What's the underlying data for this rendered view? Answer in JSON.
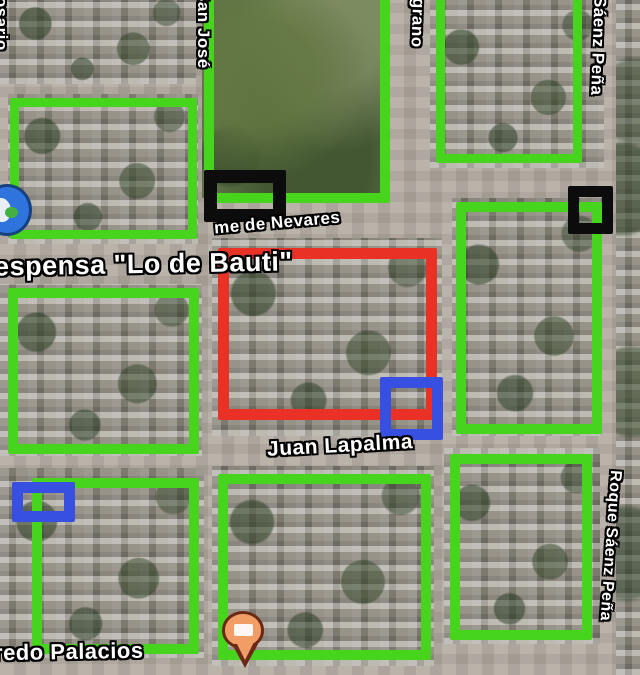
{
  "map_view": {
    "type": "satellite-map-screenshot",
    "width": 640,
    "height": 675
  },
  "colors": {
    "annotation_green": "#46d41c",
    "annotation_red": "#e93126",
    "annotation_blue": "#3850e2",
    "annotation_black": "#0c0c0c",
    "road": "#b2aaa0",
    "block": "#8f8b80",
    "field_green": "#5e7247",
    "label_text": "#ffffff",
    "label_halo": "#000000",
    "pin_fill": "#f09e66",
    "pin_border": "#6b2815",
    "pin_glyph": "#ffffff",
    "poi_icon_fill": "#2e74dc"
  },
  "street_labels": [
    {
      "name": "street-label-rosario",
      "text": "Rosario",
      "vertical": true,
      "x": -8,
      "y": -16,
      "size": 17,
      "rot": 0
    },
    {
      "name": "street-label-san-jose",
      "text": "San José",
      "vertical": true,
      "x": 194,
      "y": -10,
      "size": 17,
      "rot": 0
    },
    {
      "name": "street-label-belgrano",
      "text": "Belgrano",
      "vertical": true,
      "x": 409,
      "y": -30,
      "size": 17,
      "rot": 2
    },
    {
      "name": "street-label-saenz-pena",
      "text": "Sáenz Peña",
      "vertical": true,
      "x": 589,
      "y": -4,
      "size": 17,
      "rot": 2
    },
    {
      "name": "street-label-jaime-de-nevares",
      "text": "me de Nevares",
      "vertical": false,
      "x": 214,
      "y": 214,
      "size": 17,
      "rot": -5
    },
    {
      "name": "poi-label-despensa",
      "text": "espensa \"Lo de Bauti\"",
      "vertical": false,
      "x": -6,
      "y": 250,
      "size": 27,
      "rot": -1
    },
    {
      "name": "street-label-juan-lapalma",
      "text": "Juan Lapalma",
      "vertical": false,
      "x": 267,
      "y": 435,
      "size": 21,
      "rot": -3
    },
    {
      "name": "street-label-alfredo-palacios",
      "text": "redo Palacios",
      "vertical": false,
      "x": -6,
      "y": 640,
      "size": 22,
      "rot": -1
    },
    {
      "name": "street-label-roque-saenz-pena",
      "text": "Roque Sáenz Peña",
      "vertical": true,
      "x": 601,
      "y": 470,
      "size": 16,
      "rot": 4
    }
  ],
  "annotations": [
    {
      "name": "green-box-top-left",
      "color": "green",
      "x": 10,
      "y": 98,
      "w": 187,
      "h": 141,
      "stroke": 9,
      "z": 3
    },
    {
      "name": "green-box-park",
      "color": "green",
      "x": 204,
      "y": -28,
      "w": 186,
      "h": 231,
      "stroke": 10,
      "z": 3
    },
    {
      "name": "green-box-top-right",
      "color": "green",
      "x": 436,
      "y": -24,
      "w": 146,
      "h": 187,
      "stroke": 9,
      "z": 3
    },
    {
      "name": "green-box-mid-left",
      "color": "green",
      "x": 8,
      "y": 288,
      "w": 191,
      "h": 166,
      "stroke": 10,
      "z": 3
    },
    {
      "name": "green-box-mid-right",
      "color": "green",
      "x": 456,
      "y": 202,
      "w": 146,
      "h": 232,
      "stroke": 10,
      "z": 3
    },
    {
      "name": "green-box-bottom-left",
      "color": "green",
      "x": 32,
      "y": 478,
      "w": 167,
      "h": 176,
      "stroke": 10,
      "z": 3
    },
    {
      "name": "green-box-bottom-middle",
      "color": "green",
      "x": 218,
      "y": 474,
      "w": 213,
      "h": 186,
      "stroke": 10,
      "z": 3
    },
    {
      "name": "green-box-bottom-right",
      "color": "green",
      "x": 450,
      "y": 454,
      "w": 142,
      "h": 186,
      "stroke": 10,
      "z": 3
    },
    {
      "name": "red-box-center",
      "color": "red",
      "x": 218,
      "y": 248,
      "w": 219,
      "h": 172,
      "stroke": 11,
      "z": 4
    },
    {
      "name": "blue-box-center",
      "color": "blue",
      "x": 380,
      "y": 377,
      "w": 63,
      "h": 63,
      "stroke": 11,
      "z": 5
    },
    {
      "name": "blue-box-bottom-left",
      "color": "blue",
      "x": 12,
      "y": 482,
      "w": 63,
      "h": 40,
      "stroke": 11,
      "z": 5
    },
    {
      "name": "black-box-nevares",
      "color": "black",
      "x": 204,
      "y": 170,
      "w": 82,
      "h": 52,
      "stroke": 13,
      "z": 5
    },
    {
      "name": "black-box-top-right",
      "color": "black",
      "x": 568,
      "y": 186,
      "w": 45,
      "h": 48,
      "stroke": 11,
      "z": 5
    }
  ],
  "markers": [
    {
      "name": "orange-map-pin",
      "x": 222,
      "y": 611
    },
    {
      "name": "blue-poi-icon",
      "x": -18,
      "y": 184
    }
  ]
}
